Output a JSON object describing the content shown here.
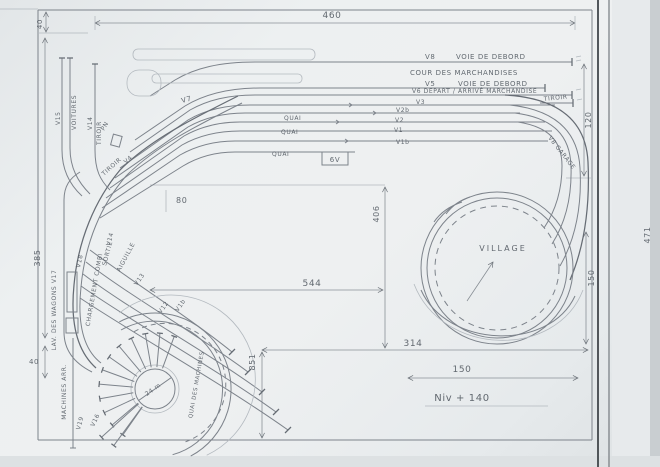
{
  "colors": {
    "paper": "#eceff0",
    "pencil": "#7d838b",
    "pencil_dark": "#41464b",
    "text": "#565d65"
  },
  "dimensions": {
    "top_width": "460",
    "top_left_margin": "40",
    "left_height": "385",
    "bottom_left_margin": "40",
    "right_height": "120",
    "center_height": "406",
    "center_width": "544",
    "bottom_height": "851",
    "loop_width": "314",
    "loop_diameter": "150",
    "loop_right_height": "150",
    "sheet_height": "471",
    "track_gap": "80",
    "level_note": "Niv + 140"
  },
  "station": {
    "v8": "V8",
    "v8_name": "VOIE DE DEBORD",
    "yard": "COUR DES MARCHANDISES",
    "v5": "V5",
    "v5_name": "VOIE DE DEBORD",
    "v6_name": "V6 DEPART / ARRIVÉ MARCHANDISE",
    "tiroir": "TIROIR",
    "v3": "V3",
    "v2b": "V2b",
    "v2": "V2",
    "v1": "V1",
    "v1b": "V1b",
    "quai": "QUAI",
    "box": "6V",
    "v7": "V7",
    "v8_garage": "V8 GARAGE"
  },
  "left_yard": {
    "v15": "V15",
    "voitures": "VOITURES",
    "v14": "V14",
    "tiroir": "TIROIR",
    "pn": "PN",
    "tiroir2": "TIROIR",
    "v4": "V4",
    "lavage": "LAV. DES WAGONS V17",
    "chargement": "CHARGEMENT COMBI",
    "v18": "V18",
    "v13": "V13",
    "v14b": "V14",
    "sortie": "SORTIE",
    "aiguille": "AIGUILLE",
    "v12": "V12",
    "v1b": "V1b"
  },
  "depot": {
    "machines": "MACHINES ARR.",
    "v19": "V19",
    "v16": "V16",
    "turntable": "24 m",
    "quai_machines": "QUAI DES MACHINES"
  },
  "village": {
    "label": "VILLAGE"
  }
}
